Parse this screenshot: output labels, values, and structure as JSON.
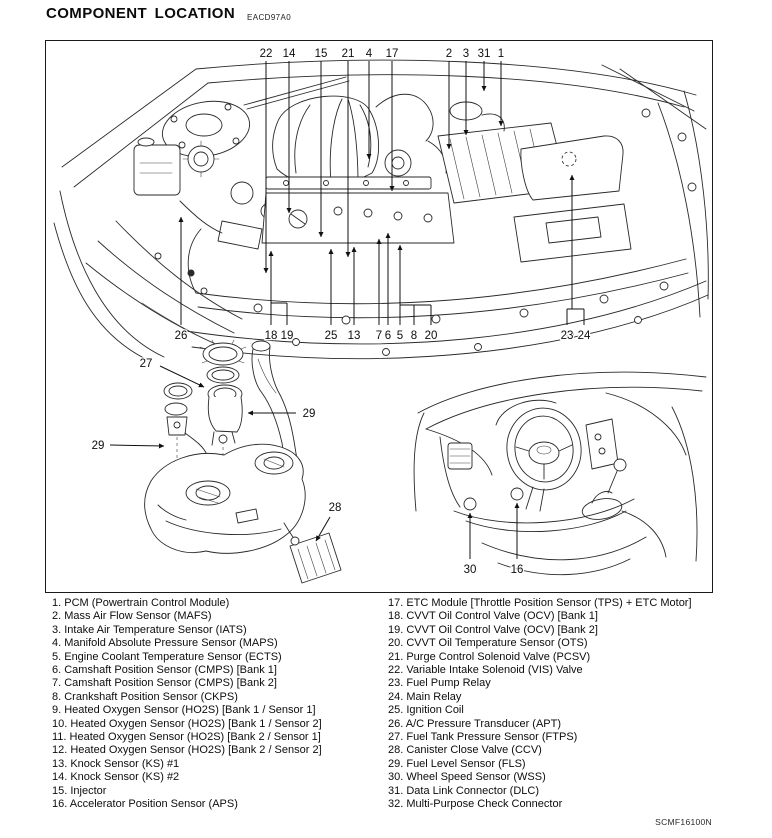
{
  "page": {
    "title": "COMPONENT LOCATION",
    "title_code": "EACD97A0",
    "footer_ref": "SCMF16100N"
  },
  "legend": {
    "left": [
      "1. PCM (Powertrain Control Module)",
      "2. Mass Air Flow Sensor (MAFS)",
      "3. Intake Air Temperature Sensor (IATS)",
      "4. Manifold Absolute Pressure Sensor (MAPS)",
      "5. Engine Coolant Temperature Sensor (ECTS)",
      "6. Camshaft Position Sensor (CMPS) [Bank 1]",
      "7. Camshaft Position Sensor (CMPS) [Bank 2]",
      "8. Crankshaft Position Sensor (CKPS)",
      "9. Heated Oxygen Sensor (HO2S) [Bank 1 / Sensor 1]",
      "10. Heated Oxygen Sensor (HO2S) [Bank 1 / Sensor 2]",
      "11. Heated Oxygen Sensor (HO2S) [Bank 2 / Sensor 1]",
      "12. Heated Oxygen Sensor (HO2S) [Bank 2 / Sensor 2]",
      "13. Knock Sensor (KS) #1",
      "14. Knock Sensor (KS) #2",
      "15. Injector",
      "16. Accelerator Position Sensor (APS)"
    ],
    "right": [
      "17. ETC Module [Throttle Position Sensor (TPS) + ETC Motor]",
      "18. CVVT Oil Control Valve (OCV) [Bank 1]",
      "19. CVVT Oil Control Valve (OCV) [Bank 2]",
      "20. CVVT Oil Temperature Sensor (OTS)",
      "21. Purge Control Solenoid Valve (PCSV)",
      "22. Variable Intake Solenoid (VIS) Valve",
      "23. Fuel Pump Relay",
      "24. Main Relay",
      "25. Ignition Coil",
      "26. A/C Pressure Transducer (APT)",
      "27. Fuel Tank Pressure Sensor (FTPS)",
      "28. Canister Close Valve (CCV)",
      "29. Fuel Level Sensor (FLS)",
      "30. Wheel Speed Sensor (WSS)",
      "31. Data Link Connector (DLC)",
      "32. Multi-Purpose Check Connector"
    ]
  },
  "callouts": {
    "engine_top": [
      "22",
      "14",
      "15",
      "21",
      "4",
      "17",
      "2",
      "3",
      "31",
      "1"
    ],
    "engine_bottom": [
      "26",
      "18",
      "19",
      "25",
      "13",
      "7",
      "6",
      "5",
      "8",
      "20",
      "23",
      "24"
    ],
    "fuel_tank": [
      "27",
      "29",
      "29",
      "28"
    ],
    "dashboard": [
      "30",
      "16"
    ]
  }
}
